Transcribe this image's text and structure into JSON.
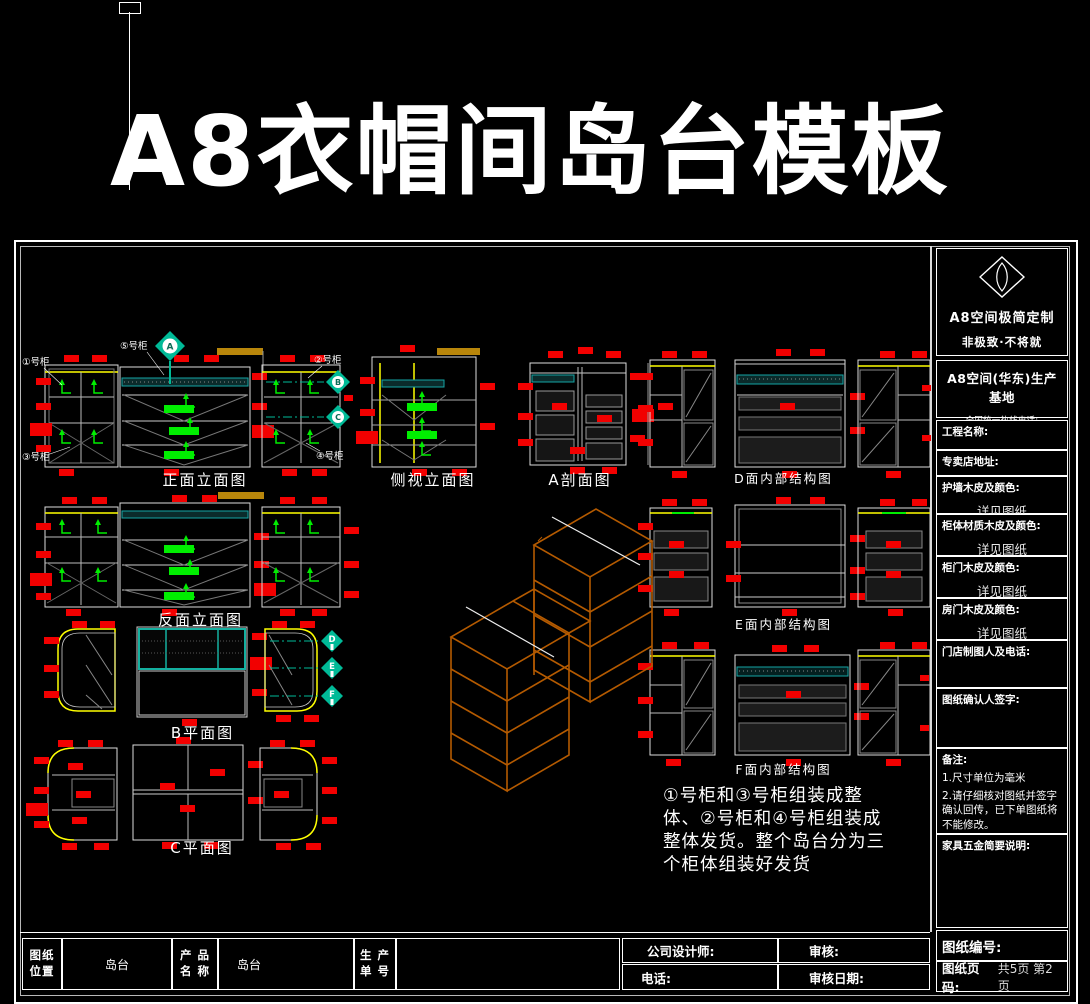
{
  "page_title": "A8衣帽间岛台模板",
  "drawings": {
    "front_elevation": "正面立面图",
    "side_elevation": "侧视立面图",
    "section_a": "A剖面图",
    "rear_elevation": "反面立面图",
    "plan_b": "B平面图",
    "plan_c": "C平面图",
    "structure_d": "D面内部结构图",
    "structure_e": "E面内部结构图",
    "structure_f": "F面内部结构图"
  },
  "cabinet_labels": {
    "c1": "①号柜",
    "c2": "②号柜",
    "c3": "③号柜",
    "c4": "④号柜",
    "c5": "⑤号柜"
  },
  "markers": {
    "a": "A",
    "b": "B",
    "c": "C",
    "d": "D",
    "e": "E",
    "f": "F"
  },
  "note": "①号柜和③号柜组装成整体、②号柜和④号柜组装成整体发货。整个岛台分为三个柜体组装好发货",
  "sidebar": {
    "brand_title": "A8空间极简定制",
    "brand_slogan": "非极致·不将就",
    "base_title": "A8空间(华东)生产基地",
    "hotline": "全国统一热线电话: 4000078678",
    "project_name_label": "工程名称:",
    "store_address_label": "专卖店地址:",
    "wall_panel_label": "护墙木皮及颜色:",
    "wall_panel_value": "详见图纸",
    "body_material_label": "柜体材质木皮及颜色:",
    "body_material_value": "详见图纸",
    "door_veneer_label": "柜门木皮及颜色:",
    "door_veneer_value": "详见图纸",
    "room_door_label": "房门木皮及颜色:",
    "room_door_value": "详见图纸",
    "store_drafter_label": "门店制图人及电话:",
    "confirm_sign_label": "图纸确认人签字:",
    "remarks_label": "备注:",
    "remarks": [
      "1.尺寸单位为毫米",
      "2.请仔细核对图纸并签字确认回传，已下单图纸将不能修改。"
    ],
    "hardware_label": "家具五金简要说明:",
    "drawing_no_label": "图纸编号:",
    "page_no_label": "图纸页码:",
    "page_no_value": "共5页 第2页"
  },
  "title_block": {
    "position_label_1": "图纸",
    "position_label_2": "位置",
    "position_value": "岛台",
    "product_label_1": "产 品",
    "product_label_2": "名 称",
    "product_value": "岛台",
    "order_label_1": "生 产",
    "order_label_2": "单 号",
    "designer_label": "公司设计师:",
    "phone_label": "电话:",
    "review_label": "审核:",
    "review_date_label": "审核日期:"
  },
  "colors": {
    "red_dimension": "#f20000",
    "green_arrow": "#00ee00",
    "teal_marker": "#00ba97",
    "counter_teal": "#14a5a5",
    "yellow_edge": "#ffff00",
    "gold_bar": "#b8860b",
    "iso_orange": "#b45a00"
  }
}
